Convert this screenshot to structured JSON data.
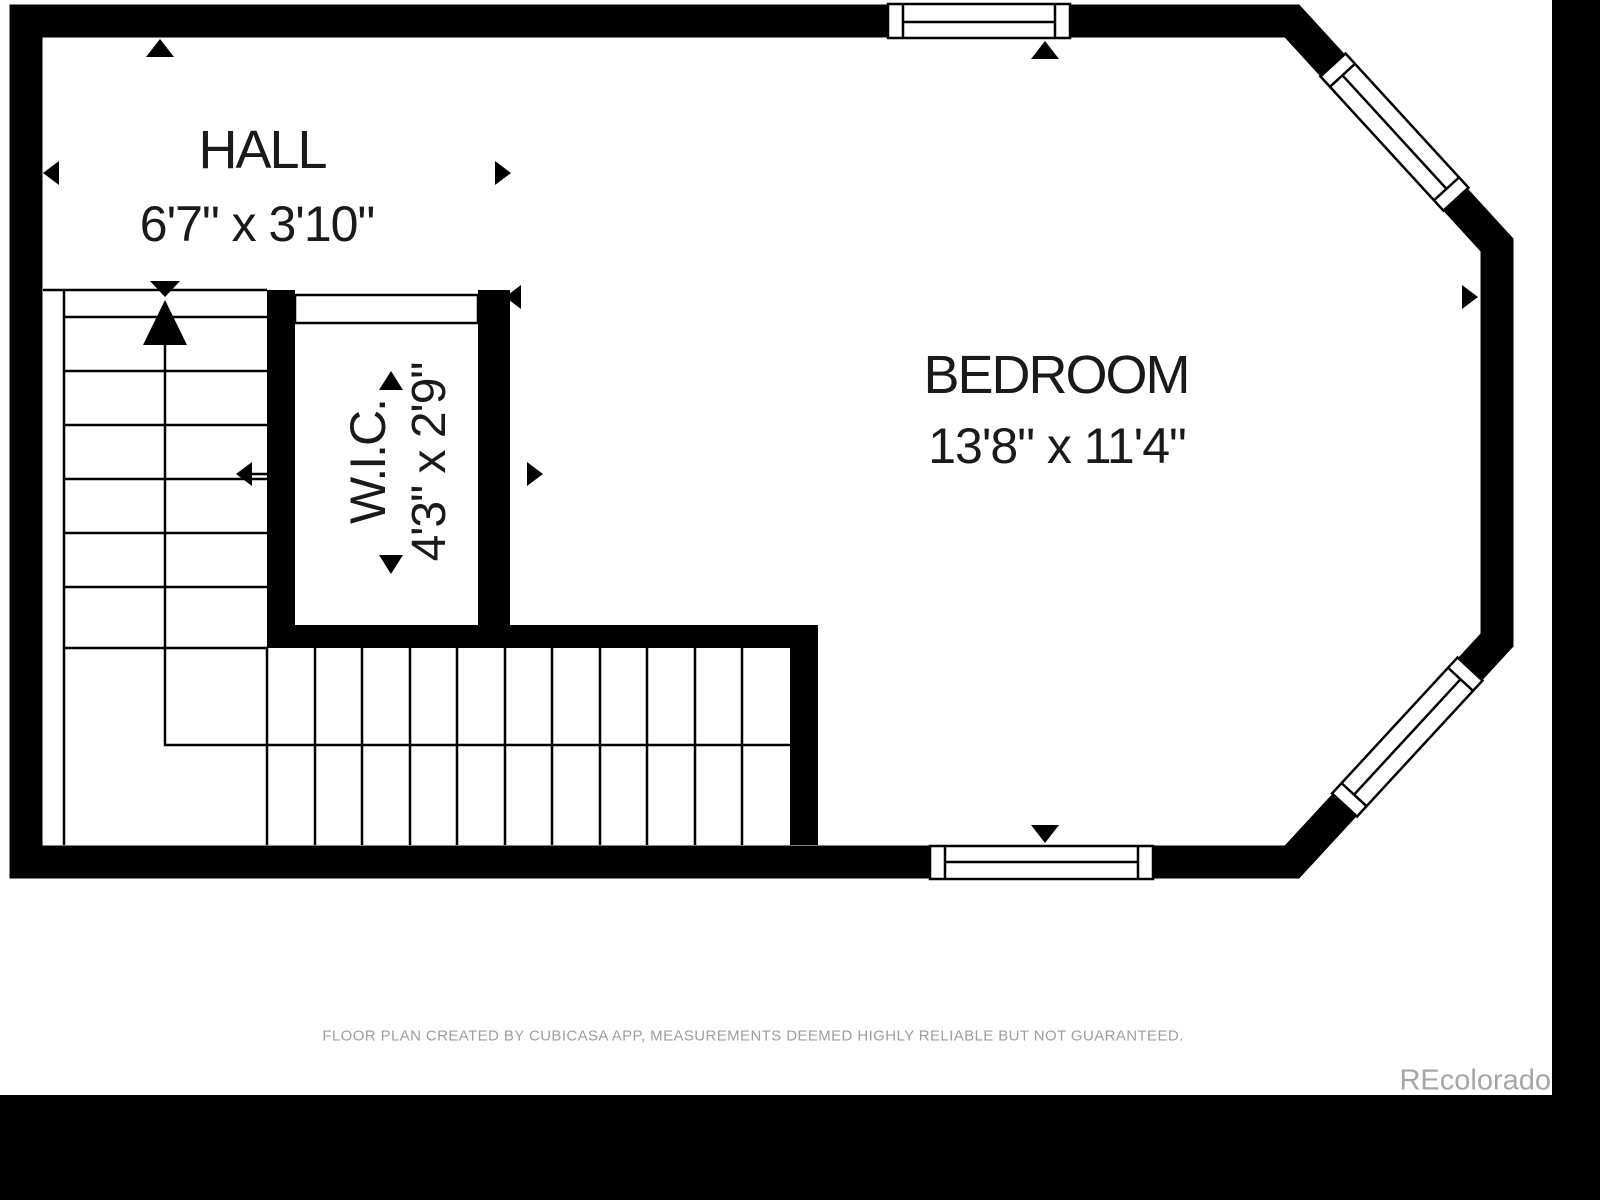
{
  "plan": {
    "rooms": {
      "hall": {
        "name": "HALL",
        "dimensions": "6'7\" x 3'10\""
      },
      "wic": {
        "name": "W.I.C.",
        "dimensions": "4'3\" x 2'9\""
      },
      "bedroom": {
        "name": "BEDROOM",
        "dimensions": "13'8\" x 11'4\""
      }
    },
    "footer": "FLOOR PLAN CREATED BY CUBICASA APP, MEASUREMENTS DEEMED HIGHLY RELIABLE BUT NOT GUARANTEED.",
    "watermark": "REcolorado",
    "colors": {
      "wall": "#000000",
      "background": "#ffffff",
      "footer_text": "#9e9e9e",
      "watermark_text": "#a6a6a6"
    }
  }
}
